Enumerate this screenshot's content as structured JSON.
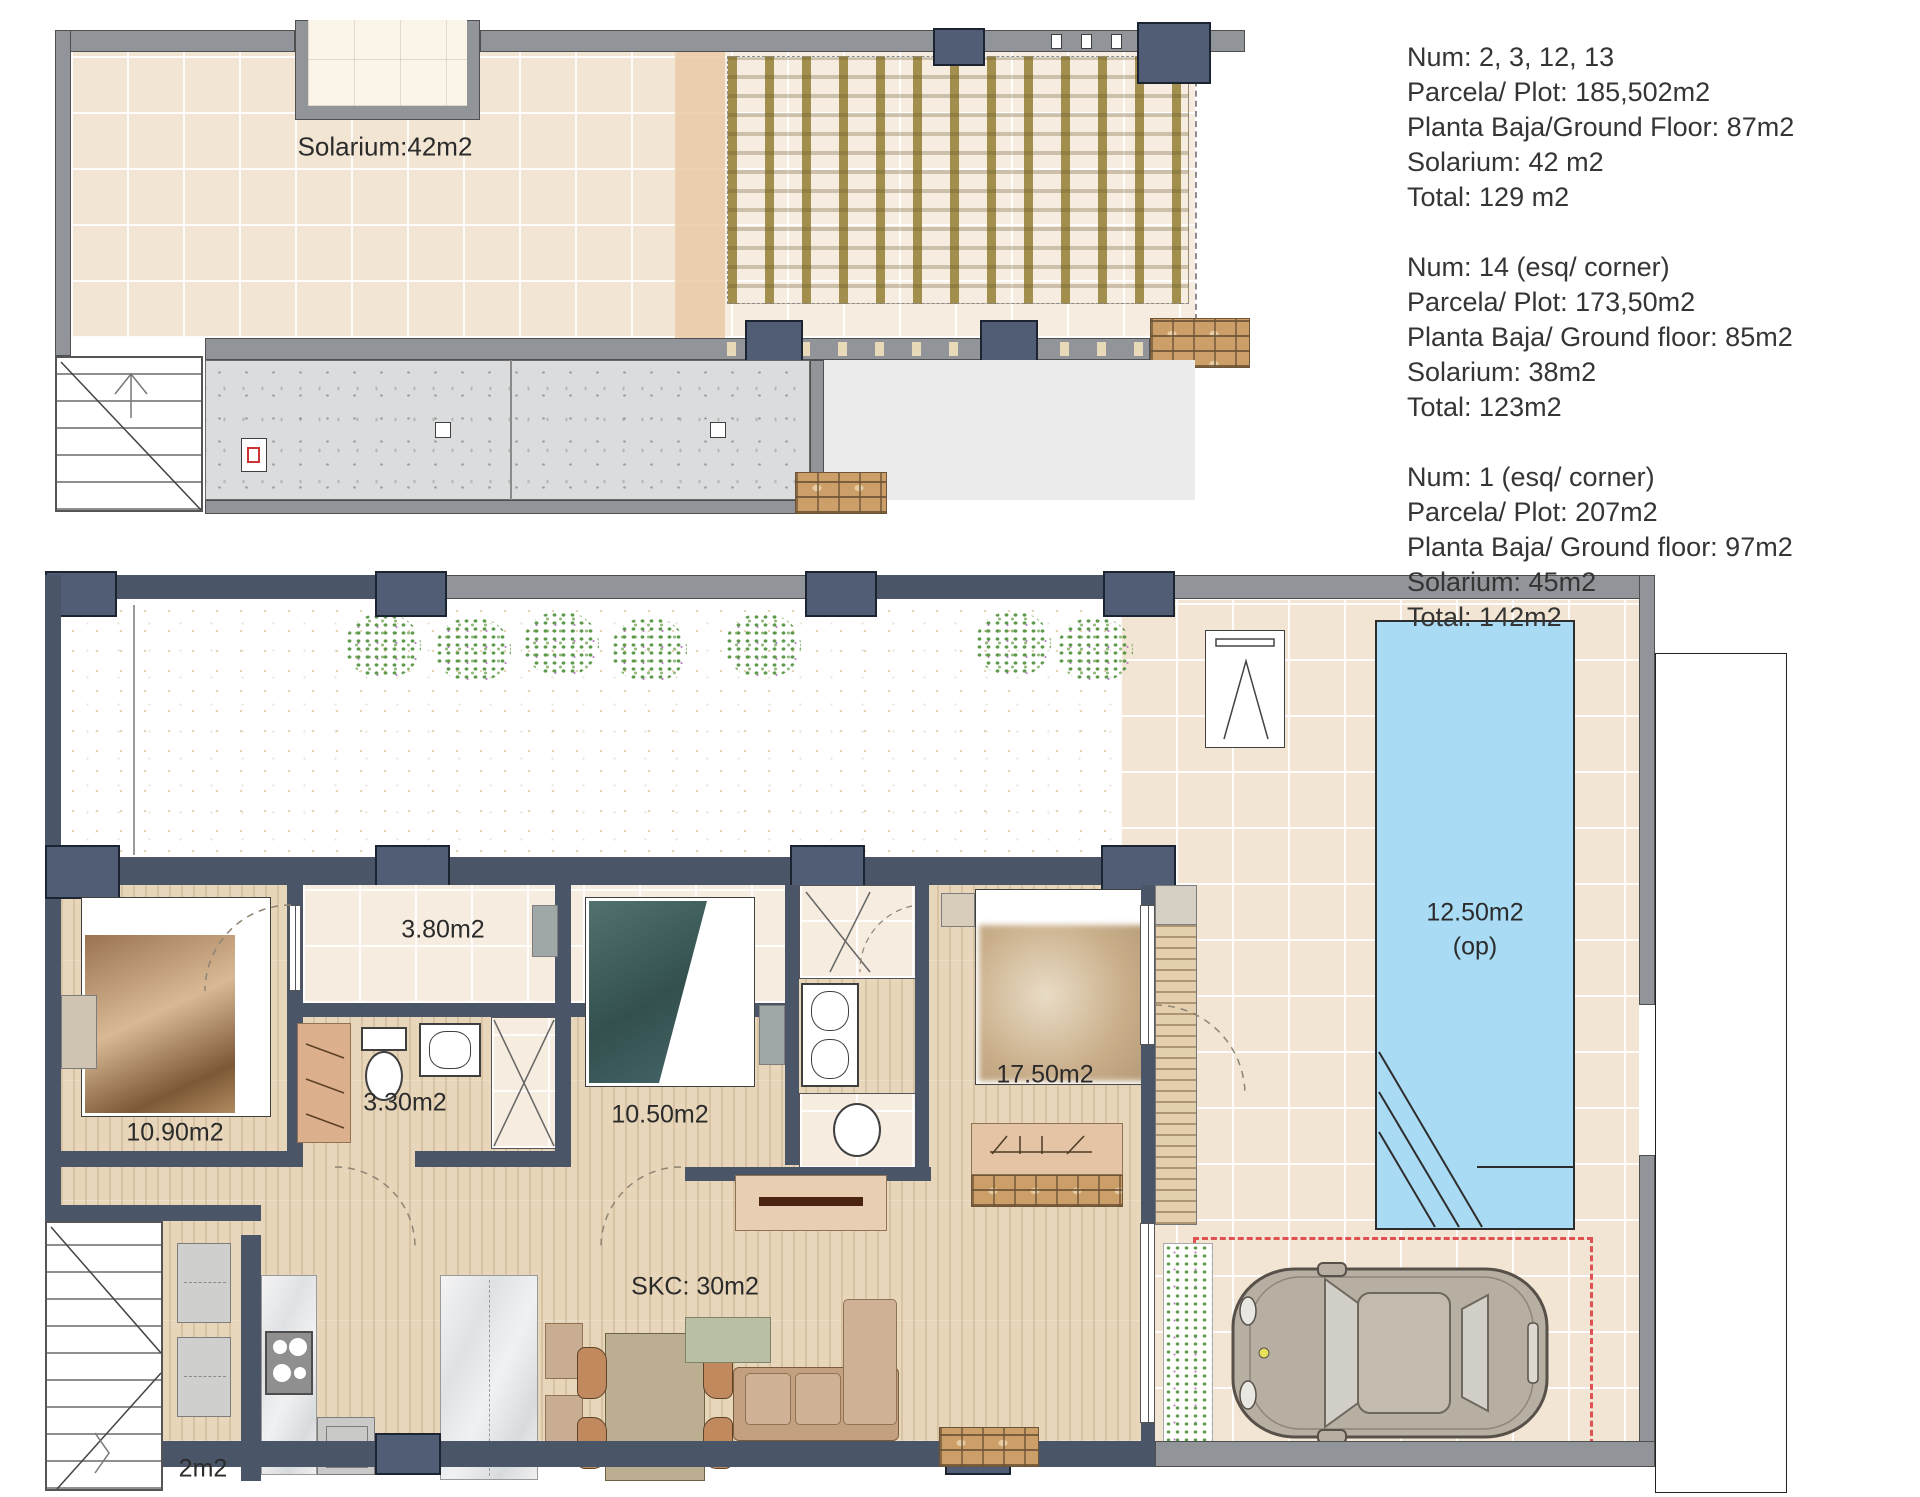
{
  "info_blocks": [
    {
      "lines": [
        "Num: 2, 3, 12, 13",
        "Parcela/ Plot: 185,502m2",
        "Planta Baja/Ground Floor: 87m2",
        "Solarium: 42 m2",
        "Total: 129 m2"
      ]
    },
    {
      "lines": [
        "Num: 14 (esq/ corner)",
        "Parcela/ Plot: 173,50m2",
        "Planta Baja/ Ground floor: 85m2",
        "Solarium: 38m2",
        "Total: 123m2"
      ]
    },
    {
      "lines": [
        "Num: 1 (esq/ corner)",
        "Parcela/ Plot: 207m2",
        "Planta Baja/ Ground floor: 97m2",
        "Solarium: 45m2",
        "Total: 142m2"
      ]
    }
  ],
  "roof_plan": {
    "solarium_label": "Solarium:42m2"
  },
  "ground_plan": {
    "porch_label": "3.80m2",
    "bathroom_label": "3.30m2",
    "bedroom1_label": "10.90m2",
    "bedroom2_label": "10.50m2",
    "bedroom3_label": "17.50m2",
    "pool_label": "12.50m2",
    "pool_sublabel": "(op)",
    "living_label": "SKC: 30m2",
    "storage_label": "2m2"
  },
  "colors": {
    "wall_gray": "#919499",
    "wall_navy": "#4a5568",
    "tile_beige": "#f3e5d3",
    "wood_floor": "#e7d6ba",
    "pool_blue": "#a9dbf4",
    "pergola_slat": "#a38f4d",
    "concrete": "#dbdcdd",
    "brick": "#cb9f67",
    "parking_dash_red": "#e05252"
  }
}
